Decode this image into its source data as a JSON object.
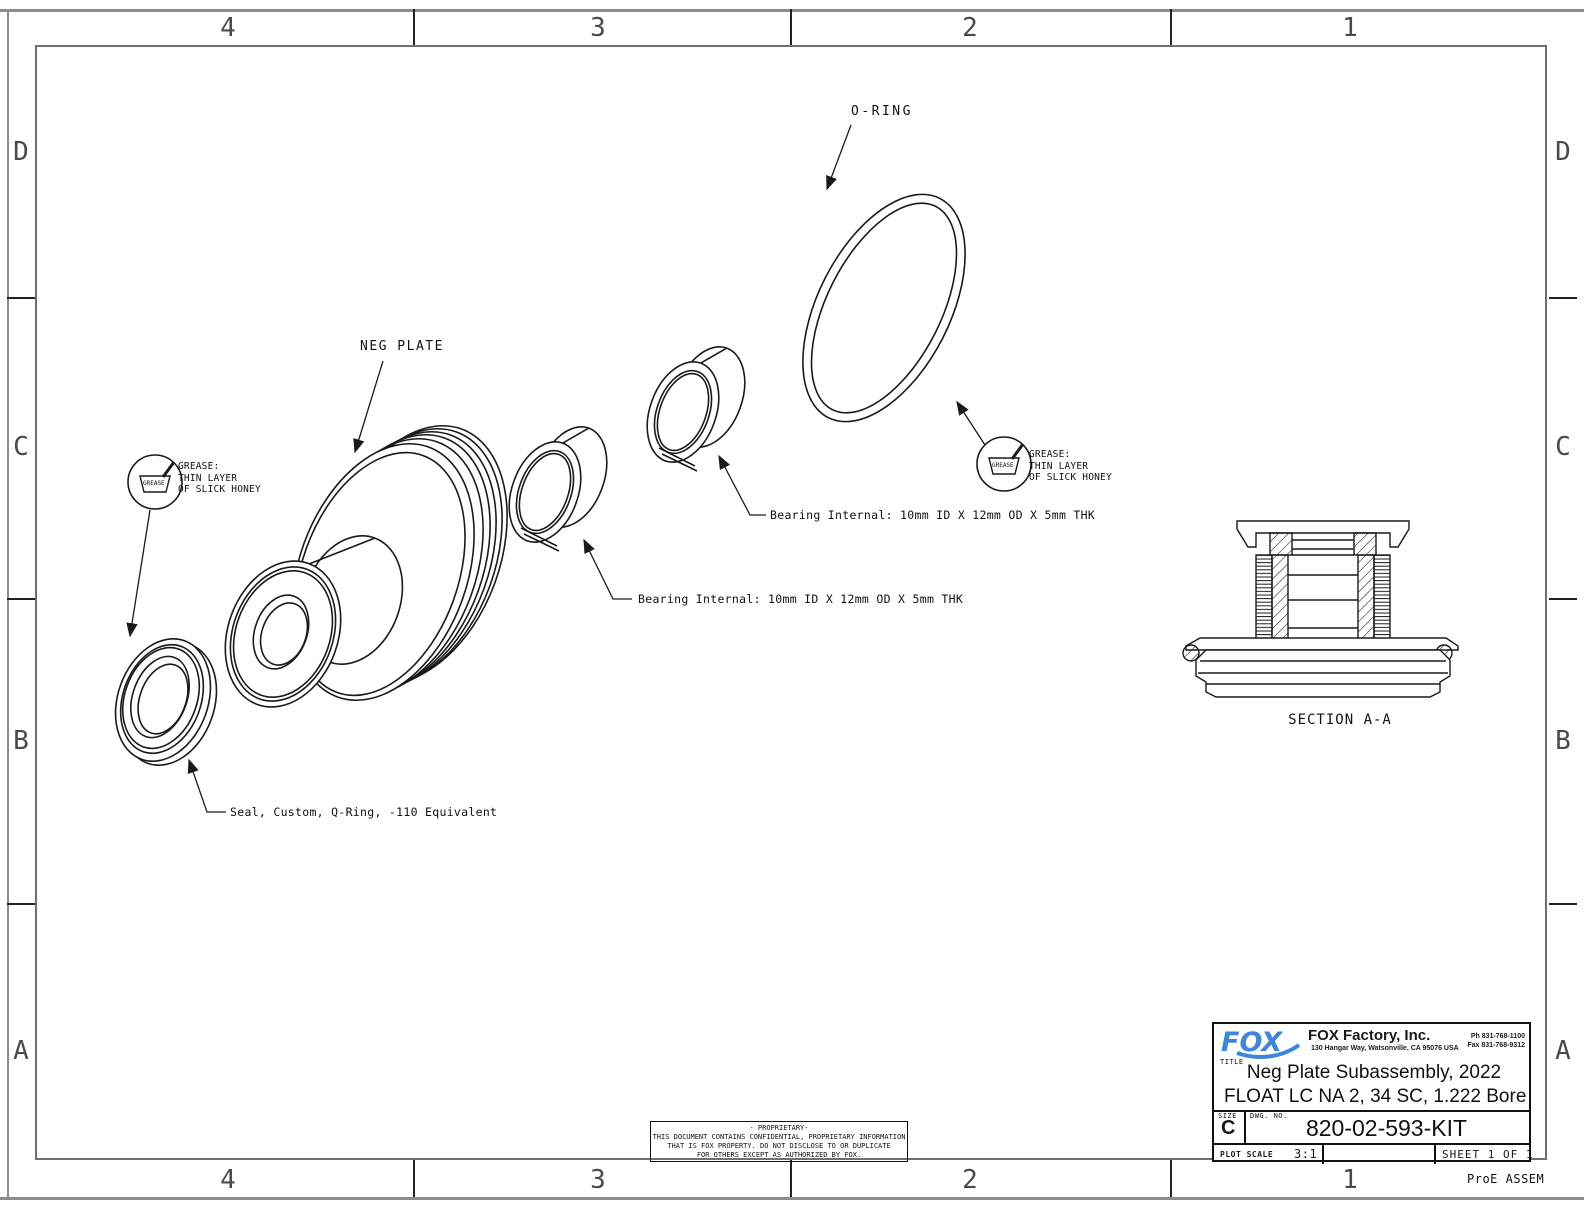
{
  "frame": {
    "zone_cols": [
      "4",
      "3",
      "2",
      "1"
    ],
    "zone_rows": [
      "D",
      "C",
      "B",
      "A"
    ],
    "footer_note": "ProE ASSEM"
  },
  "annotations": {
    "o_ring": "O-RING",
    "neg_plate": "NEG PLATE",
    "grease": {
      "line1": "GREASE:",
      "line2": "THIN LAYER",
      "line3": "OF SLICK HONEY",
      "symbol": "GREASE"
    },
    "bearing_internal": "Bearing Internal: 10mm ID X 12mm OD X 5mm THK",
    "seal": "Seal, Custom, Q-Ring, -110 Equivalent",
    "section": "SECTION A-A"
  },
  "title_block": {
    "logo_text": "FOX",
    "company": "FOX Factory, Inc.",
    "address": "130 Hangar Way, Watsonville, CA 95076 USA",
    "phone": "Ph 831-768-1100",
    "fax": "Fax 831-768-9312",
    "title_label": "TITLE",
    "title_line1": "Neg Plate Subassembly, 2022",
    "title_line2": "FLOAT LC NA 2, 34 SC, 1.222 Bore",
    "size_label": "SIZE",
    "size": "C",
    "dwg_label": "DWG. NO.",
    "dwg_no": "820-02-593-KIT",
    "plot_scale_label": "PLOT SCALE",
    "plot_scale": "3:1",
    "sheet": "SHEET 1 OF 1"
  },
  "proprietary": {
    "line1": "- PROPRIETARY-",
    "line2": "THIS DOCUMENT CONTAINS CONFIDENTIAL, PROPRIETARY INFORMATION",
    "line3": "THAT IS FOX PROPERTY.  DO NOT DISCLOSE TO OR DUPLICATE",
    "line4": "FOR OTHERS EXCEPT AS AUTHORIZED BY FOX."
  },
  "colors": {
    "logo_blue": "#3f86d8",
    "frame_gray": "#8c8c8c",
    "line_black": "#1a1a1a"
  }
}
